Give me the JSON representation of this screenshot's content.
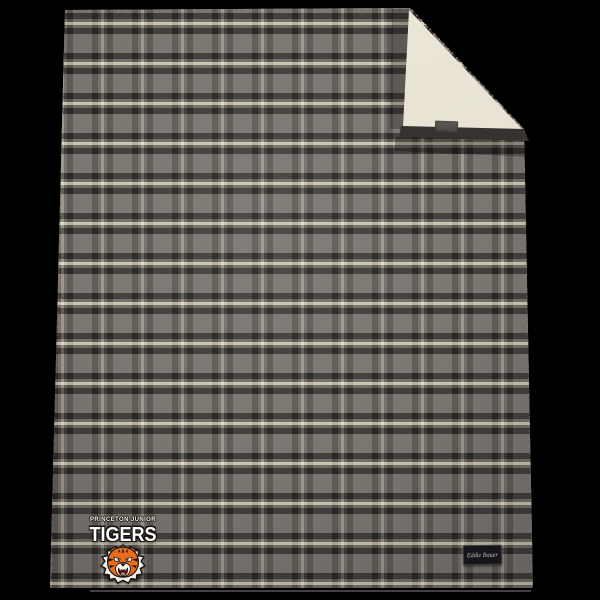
{
  "scene": {
    "background_color": "#000000",
    "subject": "plaid fleece blanket with sherpa-lined folded corner"
  },
  "blanket": {
    "pattern_name": "gray-cream plaid",
    "palette": {
      "field_gray": "#7b7670",
      "dark_stripe": "#343130",
      "cream_stripe": "#d8cfb5",
      "sherpa_cream": "#e7e2d3",
      "fold_binding": "#2b2927"
    }
  },
  "logo": {
    "top_line": "PRINCETON JUNIOR",
    "team_name": "TIGERS",
    "mascot": "tiger-head",
    "palette": {
      "tiger_orange": "#e86b1e",
      "text_white": "#ffffff",
      "outline_black": "#16130f"
    }
  },
  "brand_tag": {
    "label": "Eddie Bauer"
  }
}
